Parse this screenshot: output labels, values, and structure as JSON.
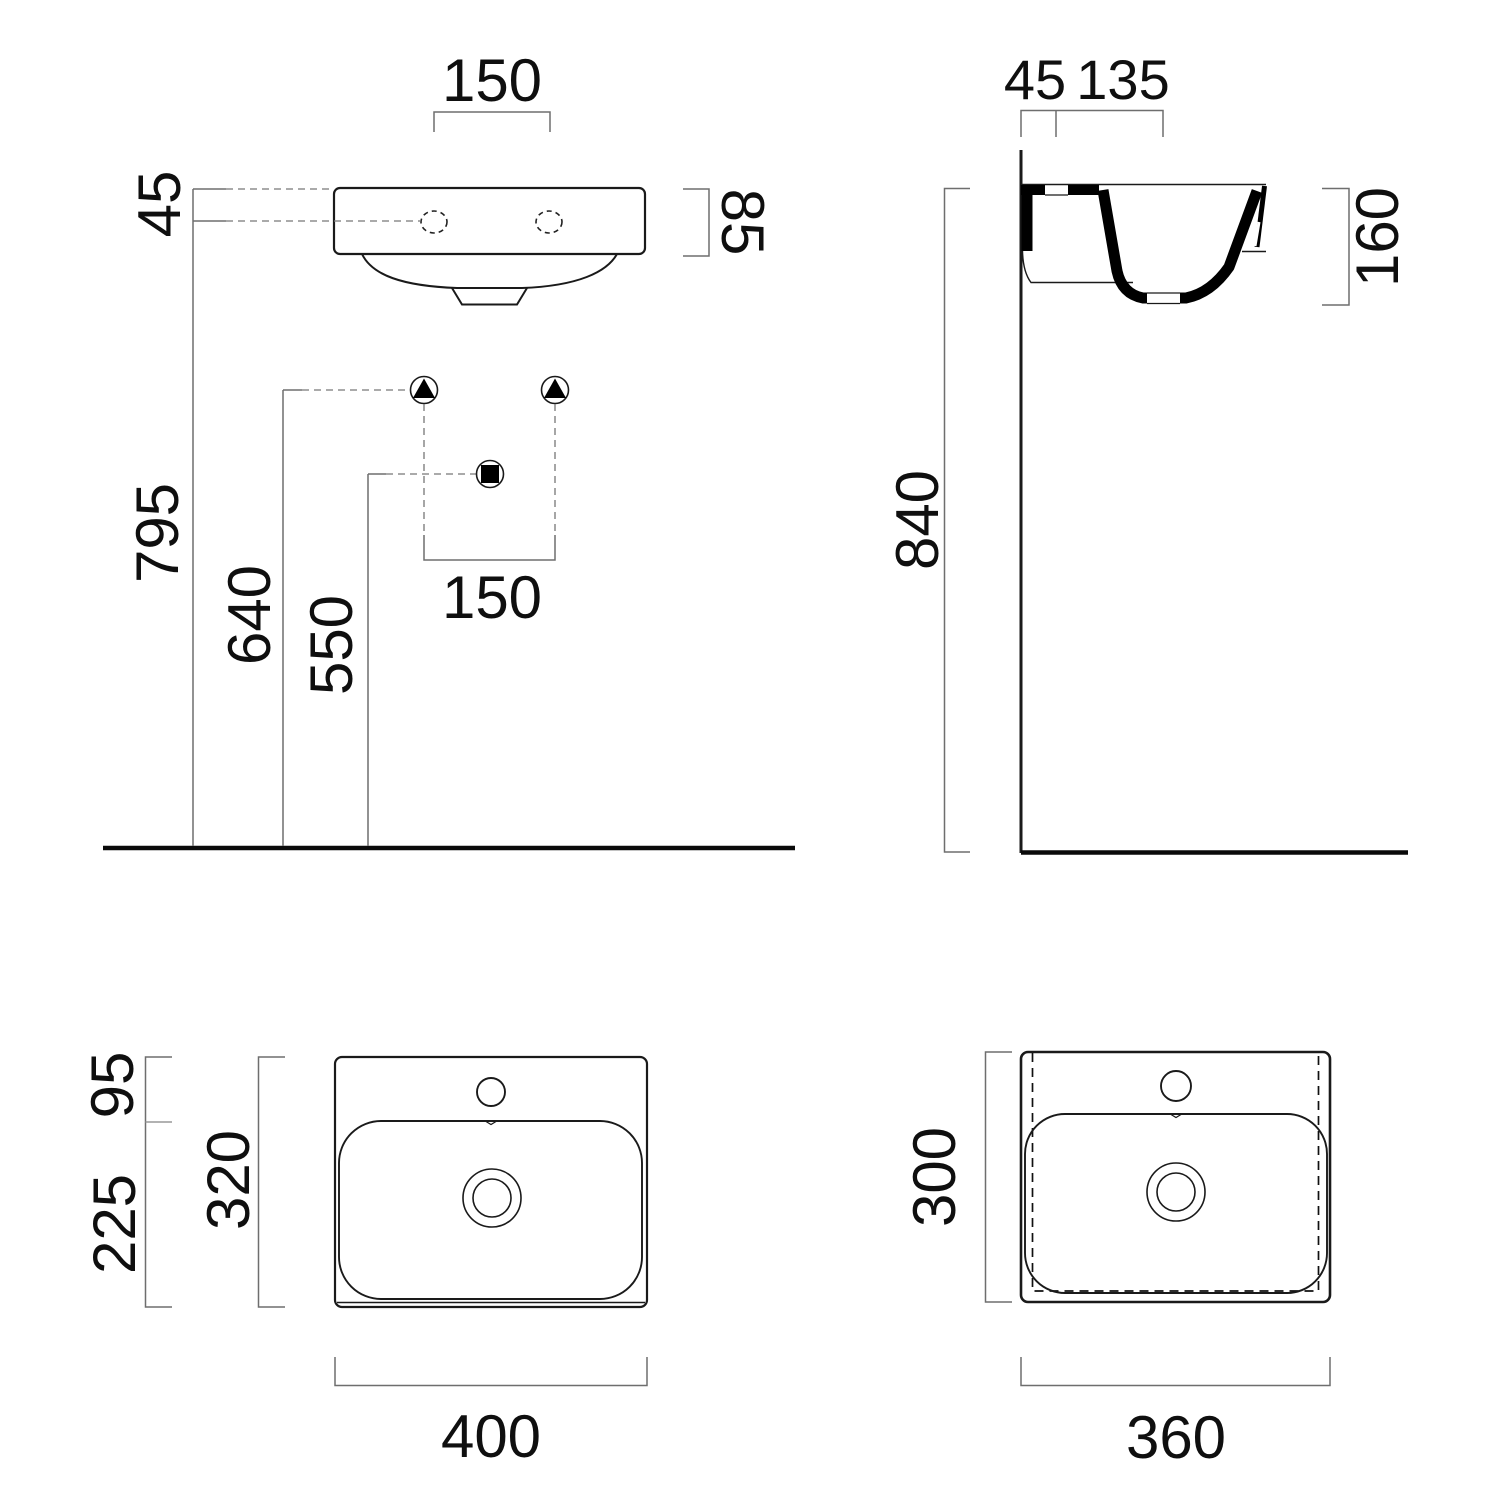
{
  "front_view": {
    "labels": {
      "hole_spacing_top": "150",
      "rim_to_holes": "45",
      "rim_height": "85",
      "holes_to_floor": "795",
      "supply_to_floor": "640",
      "waste_to_floor": "550",
      "supply_spacing": "150"
    }
  },
  "side_view": {
    "labels": {
      "wall_to_holes": "45",
      "holes_to_front": "135",
      "rim_to_trap": "160",
      "rim_to_floor": "840"
    }
  },
  "top_view": {
    "labels": {
      "back_ledge": "95",
      "bowl_depth": "225",
      "inner_depth": "320",
      "overall_width": "400"
    }
  },
  "bottom_view": {
    "labels": {
      "overall_depth": "300",
      "overall_width": "360"
    }
  },
  "symbols": {
    "water_supply_icon": "filled triangle in circle",
    "waste_outlet_icon": "filled square in circle"
  },
  "colors": {
    "line": "#1a1a1a",
    "dimension": "#6e6e6e",
    "background": "#ffffff"
  }
}
